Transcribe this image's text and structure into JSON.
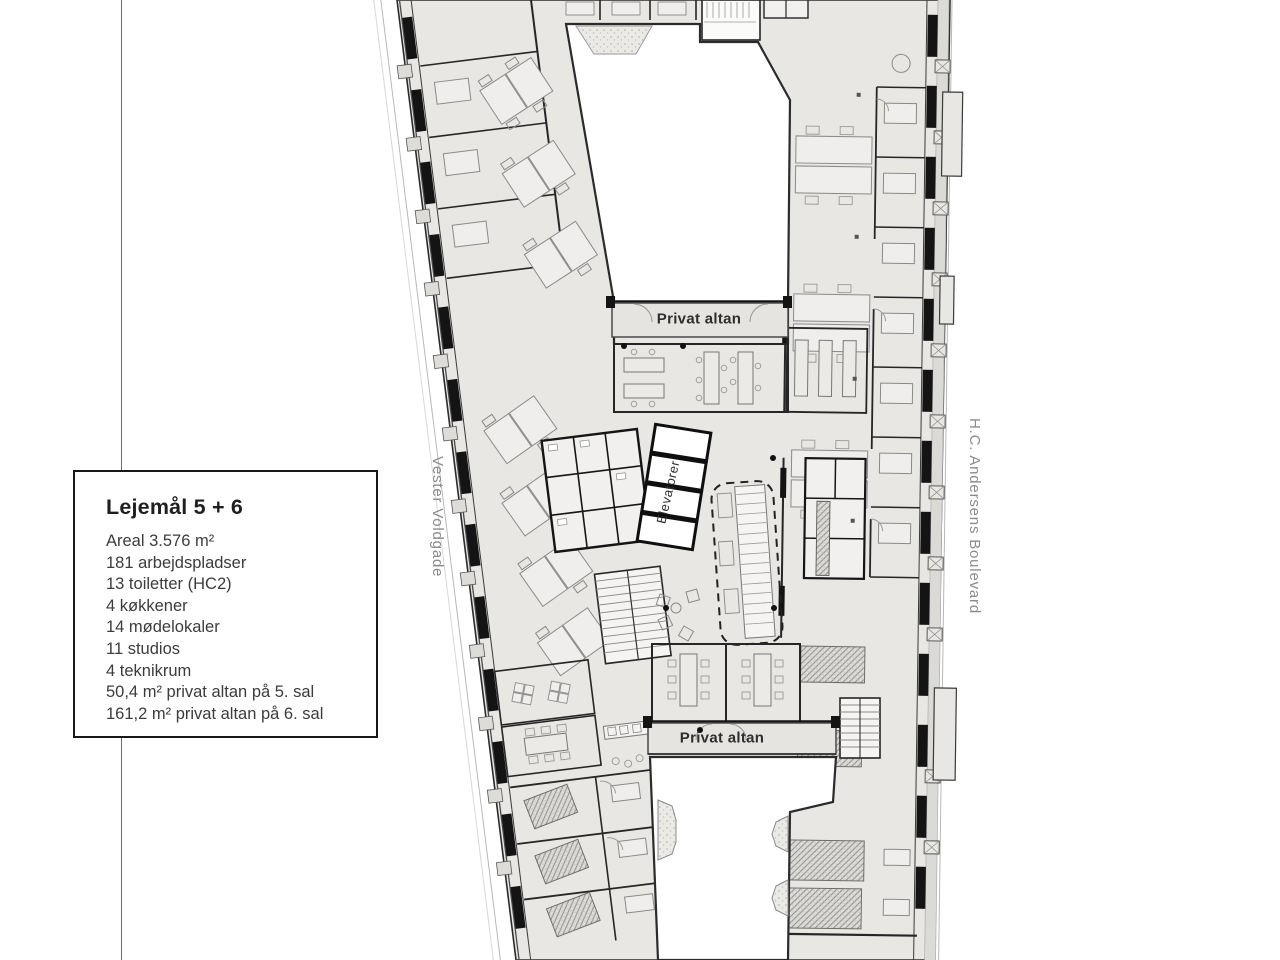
{
  "info_box": {
    "title": "Lejemål 5 + 6",
    "lines": [
      "Areal 3.576 m²",
      "181 arbejdspladser",
      "13 toiletter (HC2)",
      "4 køkkener",
      "14 mødelokaler",
      "11 studios",
      "4 teknikrum",
      "50,4 m² privat altan på 5. sal",
      "161,2 m² privat altan på 6. sal"
    ]
  },
  "streets": {
    "left": "Vester Voldgade",
    "right": "H.C. Andersens Boulevard"
  },
  "plan_labels": {
    "balcony_top": "Privat altan",
    "balcony_bottom": "Privat altan",
    "elevators": "Elevatorer"
  },
  "colors": {
    "floor_fill": "#e9e7e4",
    "wall_dark": "#141414",
    "furniture_line": "#8a8a8a",
    "street_text": "#8b8b8b",
    "background": "#ffffff"
  }
}
